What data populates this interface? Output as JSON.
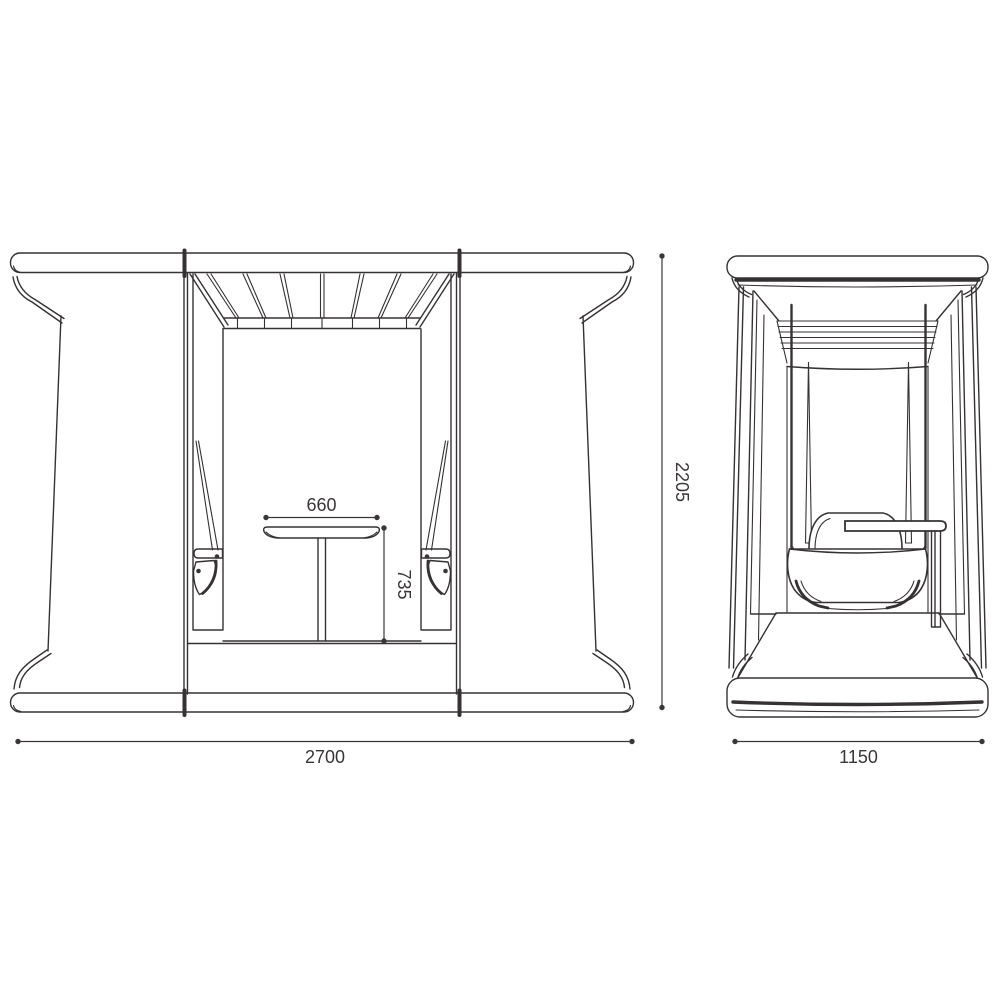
{
  "diagram": {
    "line_color": "#363233",
    "background_color": "#ffffff",
    "dimensions": {
      "overall_width": "2700",
      "overall_height": "2205",
      "overall_depth": "1150",
      "table_width": "660",
      "table_height": "735"
    }
  }
}
